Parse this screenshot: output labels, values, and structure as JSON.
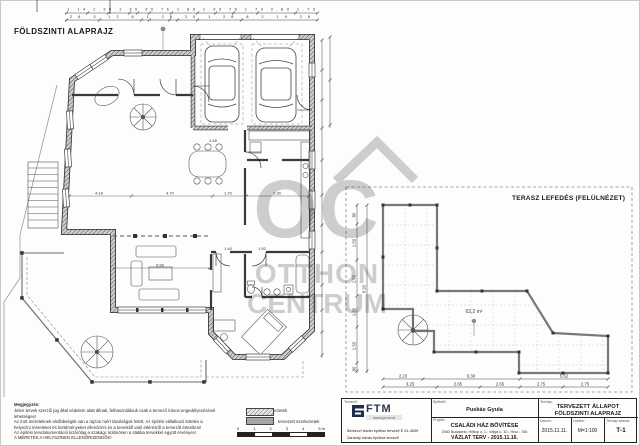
{
  "page": {
    "plan_title": "FÖLDSZINTI ALAPRAJZ",
    "terrace_title": "TERASZ LEFEDÉS (FELÜLNÉZET)"
  },
  "watermark": {
    "letters": "OC",
    "line1": "OTTHON",
    "line2": "CENTRUM"
  },
  "dims": {
    "top_row1": [
      "1.14",
      "1.30",
      "1.30",
      "30",
      "76",
      "1.88",
      "1.93",
      "76",
      "1.73",
      "2.80",
      "1.73"
    ],
    "top_row2": [
      "28",
      "3.12",
      "6",
      "1.26",
      "20",
      "1.28",
      "8",
      "2.19",
      "28"
    ],
    "plan": {
      "a": "4.18",
      "b": "4.70",
      "c": "1.70",
      "d": "2.30",
      "e": "5.95",
      "f": "1.40",
      "g": "1.92",
      "h": "2.48"
    },
    "terrace_area": "63,2 m²",
    "terrace_bottom1": [
      "2.23",
      "6.30",
      "5.62"
    ],
    "terrace_bottom2": [
      "3.25",
      "2.65",
      "2.65",
      "2.75",
      "2.75"
    ],
    "terrace_left": [
      "80",
      "1.50",
      "1.50",
      "1.30",
      "1.50",
      "80"
    ],
    "terrace_left_total": "6.92"
  },
  "notes": {
    "heading": "Megjegyzés:",
    "lines": [
      "Jelen tervek szerzői jog által védelem alatt állnak, felhasználásuk csak a tervező írásos engedélyezésével",
      "lehetséges!",
      "Az írott méreteknek elsőbbségük van a rajzon mért távolságok felett. Az építési vállalkozó köteles a",
      "helyszíni méreteket és körülményeket ellenőrizni és a tervektől való eltérésről a tervezőt értesíteni!",
      "Az építési tervdokumentáció kizárólag a szakági, különösen a statika tervekkel együtt érvényes!",
      "A MÉRETEK A HELYSZÍNEN ELLENŐRIZENDŐK!"
    ]
  },
  "legend": {
    "existing_label": "meglévő szerkezetek",
    "planned_label": "tervezett szerkezetek",
    "scale_numbers": [
      "0",
      "1",
      "2",
      "3",
      "4",
      "5 m"
    ]
  },
  "titleblock": {
    "designer_label": "Tervező:",
    "logo_text": "FTM",
    "logo_sub": "management",
    "designer_line1": "Berkeczi István    építész tervező É 01-4639",
    "designer_line2": "Zarándy István    építész tervező",
    "client_label": "Építtető:",
    "client_name": "Puskás Gyula",
    "project_label": "Projekt:",
    "project_name": "CSALÁDI HÁZ BŐVÍTÉSE",
    "project_address": "2083 Budapest, Hilltop u. 1., Válya u. 10., Hrsz.: 765",
    "project_phase": "VÁZLAT TERV - 2015.11.16.",
    "sheet_label": "Tervlap:",
    "sheet_name_line1": "TERVEZETT ÁLLAPOT",
    "sheet_name_line2": "FÖLDSZINTI ALAPRAJZ",
    "date_label": "Dátum:",
    "date_value": "2015.11.11.",
    "scale_label": "Lépték:",
    "scale_value": "M=1:100",
    "sheetno_label": "Tervlap száma:",
    "sheetno_value": "T-1"
  }
}
